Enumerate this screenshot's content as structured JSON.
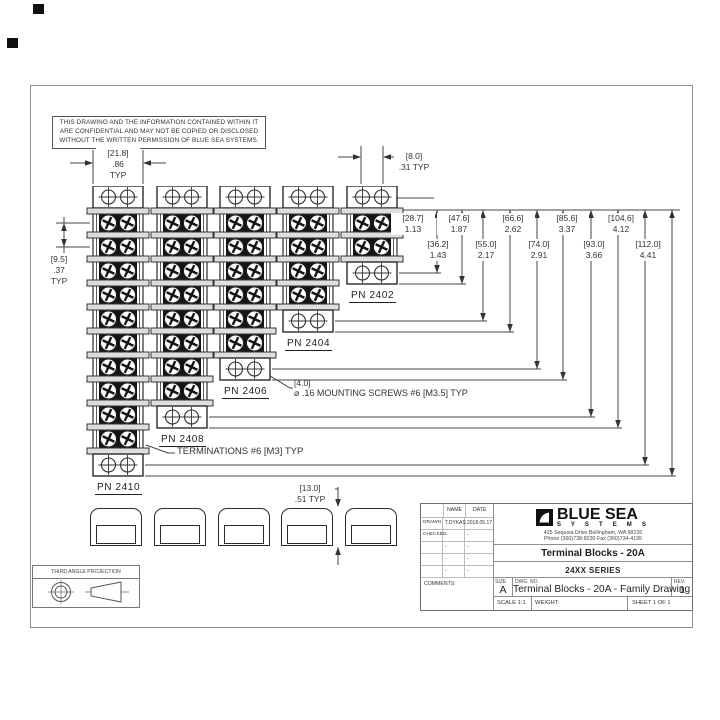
{
  "page": {
    "confidential": [
      "THIS DRAWING AND THE INFORMATION CONTAINED WITHIN IT",
      "ARE CONFIDENTIAL AND MAY NOT BE COPIED OR DISCLOSED",
      "WITHOUT THE WRITTEN PERMISSION OF BLUE SEA SYSTEMS."
    ]
  },
  "blocks": [
    {
      "pn": "PN 2410",
      "rows": 10
    },
    {
      "pn": "PN 2408",
      "rows": 8
    },
    {
      "pn": "PN 2406",
      "rows": 6
    },
    {
      "pn": "PN 2404",
      "rows": 4
    },
    {
      "pn": "PN 2402",
      "rows": 2
    }
  ],
  "dims": {
    "block_width": {
      "mm": "[21.8]",
      "in": ".86",
      "typ": "TYP"
    },
    "screw_spacing": {
      "mm": "[8.0]",
      "in": ".31 TYP"
    },
    "pitch": {
      "mm": "[9.5]",
      "in": ".37",
      "typ": "TYP"
    },
    "height": {
      "mm": "[13.0]",
      "in": ".51 TYP"
    },
    "ladder": [
      {
        "mm": "[28.7]",
        "in": "1.13"
      },
      {
        "mm": "[36.2]",
        "in": "1.43"
      },
      {
        "mm": "[47.6]",
        "in": "1.87"
      },
      {
        "mm": "[55.0]",
        "in": "2.17"
      },
      {
        "mm": "[66.6]",
        "in": "2.62"
      },
      {
        "mm": "[74.0]",
        "in": "2.91"
      },
      {
        "mm": "[85.6]",
        "in": "3.37"
      },
      {
        "mm": "[93.0]",
        "in": "3.66"
      },
      {
        "mm": "[104.6]",
        "in": "4.12"
      },
      {
        "mm": "[112.0]",
        "in": "4.41"
      }
    ]
  },
  "notes": {
    "mounting_dim": "[4.0]",
    "mounting": "⌀ .16 MOUNTING SCREWS #6 [M3.5] TYP",
    "terminations": "TERMINATIONS #6 [M3] TYP"
  },
  "projection_label": "THIRD ANGLE PROJECTION",
  "title_block": {
    "headers": {
      "name": "NAME",
      "date": "DATE"
    },
    "rows": [
      {
        "label": "DRAWN",
        "name": "T.DYKAS",
        "date": "2018.05.17"
      },
      {
        "label": "CHECKED",
        "name": "-",
        "date": "-"
      },
      {
        "label": "",
        "name": "-",
        "date": "-"
      },
      {
        "label": "",
        "name": "-",
        "date": "-"
      },
      {
        "label": "",
        "name": "-",
        "date": "-"
      }
    ],
    "comments_label": "COMMENTS:",
    "company": {
      "name": "BLUE SEA",
      "sub": "S Y S T E M S",
      "address": "425 Sequoia Drive   Bellingham, WA 98226",
      "phone": "Phone (360)738-8230   Fax (360)734-4195"
    },
    "product": "Terminal Blocks - 20A",
    "series": "24XX SERIES",
    "size_label": "SIZE",
    "size": "A",
    "dwg_label": "DWG. NO.",
    "dwg": "Terminal Blocks - 20A - Family Drawing",
    "rev_label": "REV.",
    "rev": "1",
    "scale": "SCALE 1:1",
    "weight": "WEIGHT:",
    "sheet": "SHEET 1 OF 1"
  }
}
